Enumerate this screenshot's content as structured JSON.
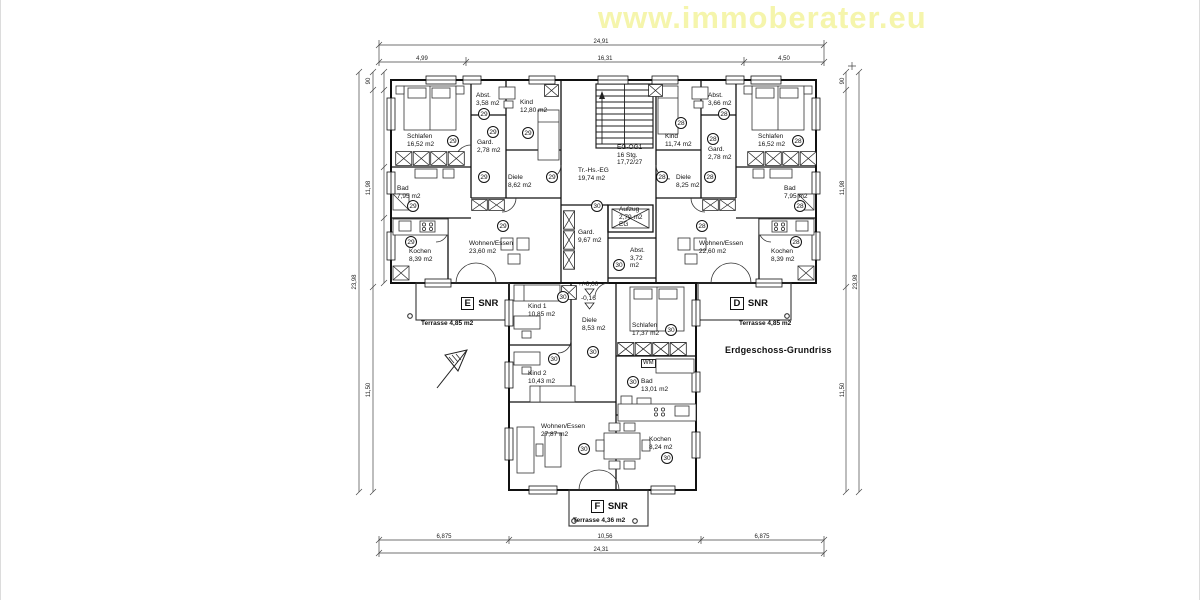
{
  "watermark": {
    "text": "www.immoberater.eu",
    "color": "#f5f5ac"
  },
  "plan": {
    "rooms": [
      {
        "id": "e-schlafen",
        "name": "Schlafen",
        "area": "16,52 m2",
        "x": 406,
        "y": 133,
        "badge": "29",
        "bx": 446,
        "by": 135
      },
      {
        "id": "e-abst",
        "name": "Abst.",
        "area": "3,58 m2",
        "x": 475,
        "y": 92,
        "badge": "29",
        "bx": 477,
        "by": 108
      },
      {
        "id": "e-kind",
        "name": "Kind",
        "area": "12,80 m2",
        "x": 519,
        "y": 99,
        "badge": "29",
        "bx": 521,
        "by": 127
      },
      {
        "id": "e-gard",
        "name": "Gard.",
        "area": "2,78 m2",
        "x": 476,
        "y": 139,
        "badge": "29",
        "bx": 486,
        "by": 126
      },
      {
        "id": "e-diele",
        "name": "Diele",
        "area": "8,62 m2",
        "x": 507,
        "y": 174,
        "badge": "29",
        "bx": 545,
        "by": 171
      },
      {
        "id": "e-bad",
        "name": "Bad",
        "area": "7,95 m2",
        "x": 396,
        "y": 185,
        "badge": "29",
        "bx": 406,
        "by": 200
      },
      {
        "id": "e-kochen",
        "name": "Kochen",
        "area": "8,39 m2",
        "x": 408,
        "y": 248,
        "badge": "29",
        "bx": 404,
        "by": 236
      },
      {
        "id": "e-wohnen",
        "name": "Wohnen/Essen",
        "area": "23,60 m2",
        "x": 468,
        "y": 240,
        "badge": "29",
        "bx": 496,
        "by": 220
      },
      {
        "id": "d-kind",
        "name": "Kind",
        "area": "11,74 m2",
        "x": 664,
        "y": 133,
        "badge": "28",
        "bx": 674,
        "by": 117
      },
      {
        "id": "d-abst",
        "name": "Abst.",
        "area": "3,66 m2",
        "x": 707,
        "y": 92,
        "badge": "28",
        "bx": 717,
        "by": 108
      },
      {
        "id": "d-gard",
        "name": "Gard.",
        "area": "2,78 m2",
        "x": 707,
        "y": 146,
        "badge": "28",
        "bx": 706,
        "by": 133
      },
      {
        "id": "d-schlafen",
        "name": "Schlafen",
        "area": "16,52 m2",
        "x": 757,
        "y": 133,
        "badge": "28",
        "bx": 791,
        "by": 135
      },
      {
        "id": "d-diele",
        "name": "Diele",
        "area": "8,25 m2",
        "x": 675,
        "y": 174,
        "badge": "28",
        "bx": 703,
        "by": 171
      },
      {
        "id": "d-bad",
        "name": "Bad",
        "area": "7,95 m2",
        "x": 783,
        "y": 185,
        "badge": "28",
        "bx": 793,
        "by": 200
      },
      {
        "id": "d-kochen",
        "name": "Kochen",
        "area": "8,39 m2",
        "x": 770,
        "y": 248,
        "badge": "28",
        "bx": 789,
        "by": 236
      },
      {
        "id": "d-wohnen",
        "name": "Wohnen/Essen",
        "area": "22,60 m2",
        "x": 698,
        "y": 240,
        "badge": "28",
        "bx": 695,
        "by": 220
      },
      {
        "id": "f-kind1",
        "name": "Kind 1",
        "area": "10,85 m2",
        "x": 527,
        "y": 303,
        "badge": "30",
        "bx": 556,
        "by": 291
      },
      {
        "id": "f-diele",
        "name": "Diele",
        "area": "8,53 m2",
        "x": 581,
        "y": 317,
        "badge": "30",
        "bx": 586,
        "by": 346
      },
      {
        "id": "f-schlafen",
        "name": "Schlafen",
        "area": "17,37 m2",
        "x": 631,
        "y": 322,
        "badge": "30",
        "bx": 664,
        "by": 324
      },
      {
        "id": "f-kind2",
        "name": "Kind 2",
        "area": "10,43 m2",
        "x": 527,
        "y": 370,
        "badge": "30",
        "bx": 547,
        "by": 353
      },
      {
        "id": "f-bad",
        "name": "Bad",
        "area": "13,01 m2",
        "x": 640,
        "y": 378,
        "badge": "30",
        "bx": 626,
        "by": 376
      },
      {
        "id": "f-wohnen",
        "name": "Wohnen/Essen",
        "area": "27,87 m2",
        "x": 540,
        "y": 423,
        "badge": "30",
        "bx": 577,
        "by": 443
      },
      {
        "id": "f-kochen",
        "name": "Kochen",
        "area": "8,24 m2",
        "x": 648,
        "y": 436,
        "badge": "30",
        "bx": 660,
        "by": 452
      }
    ],
    "extra_badges": [
      {
        "n": "29",
        "x": 477,
        "y": 171
      },
      {
        "n": "28",
        "x": 655,
        "y": 171
      },
      {
        "n": "30",
        "x": 590,
        "y": 200
      },
      {
        "n": "30",
        "x": 612,
        "y": 259
      }
    ],
    "notes": [
      {
        "id": "stairwell-label",
        "lines": [
          "Tr.-Hs.-EG",
          "19,74 m2"
        ],
        "x": 577,
        "y": 167
      },
      {
        "id": "stairs-label",
        "lines": [
          "EG-OG1",
          "16 Stg.",
          "17,72/27"
        ],
        "x": 616,
        "y": 144
      },
      {
        "id": "elevator-label",
        "lines": [
          "Aufzug",
          "2,79 m2",
          "EG"
        ],
        "x": 618,
        "y": 206
      },
      {
        "id": "core-gard-label",
        "lines": [
          "Gard.",
          "9,67 m2"
        ],
        "x": 577,
        "y": 229
      },
      {
        "id": "core-abst-label",
        "lines": [
          "Abst.",
          "3,72",
          "m2"
        ],
        "x": 629,
        "y": 247
      },
      {
        "id": "level-mark-upper",
        "lines": [
          "+/-0,00"
        ],
        "x": 577,
        "y": 281
      },
      {
        "id": "level-mark-lower",
        "lines": [
          "-0,16"
        ],
        "x": 580,
        "y": 295
      },
      {
        "id": "washer-label",
        "lines": [
          "WM"
        ],
        "cls": "boxed",
        "x": 640,
        "y": 359
      },
      {
        "id": "terrace-label-e",
        "lines": [
          "Terrasse 4,85 m2"
        ],
        "cls": "bold",
        "x": 420,
        "y": 320
      },
      {
        "id": "terrace-label-d",
        "lines": [
          "Terrasse 4,85 m2"
        ],
        "cls": "bold",
        "x": 738,
        "y": 320
      },
      {
        "id": "terrace-label-f",
        "lines": [
          "Terrasse 4,36 m2"
        ],
        "cls": "bold",
        "x": 572,
        "y": 517
      },
      {
        "id": "drawing-title",
        "lines": [
          "Erdgeschoss-Grundriss"
        ],
        "cls": "title",
        "x": 724,
        "y": 345
      }
    ],
    "unit_tags": [
      {
        "letter": "E",
        "text": "SNR",
        "x": 460,
        "y": 297
      },
      {
        "letter": "D",
        "text": "SNR",
        "x": 729,
        "y": 297
      },
      {
        "letter": "F",
        "text": "SNR",
        "x": 590,
        "y": 500
      }
    ]
  },
  "dims": {
    "top_total": "24,91",
    "top_s1": "4,99",
    "top_s2": "16,31",
    "top_s3": "4,50",
    "bottom_s1": "6,875",
    "bottom_s2": "10,56",
    "bottom_s3": "6,875",
    "bottom_total": "24,31",
    "left_top": "90",
    "left_upper": "11,98",
    "left_lower": "11,50",
    "left_total": "23,98",
    "right_top": "90",
    "right_upper": "11,98",
    "right_lower": "11,50",
    "right_total": "23,98"
  }
}
